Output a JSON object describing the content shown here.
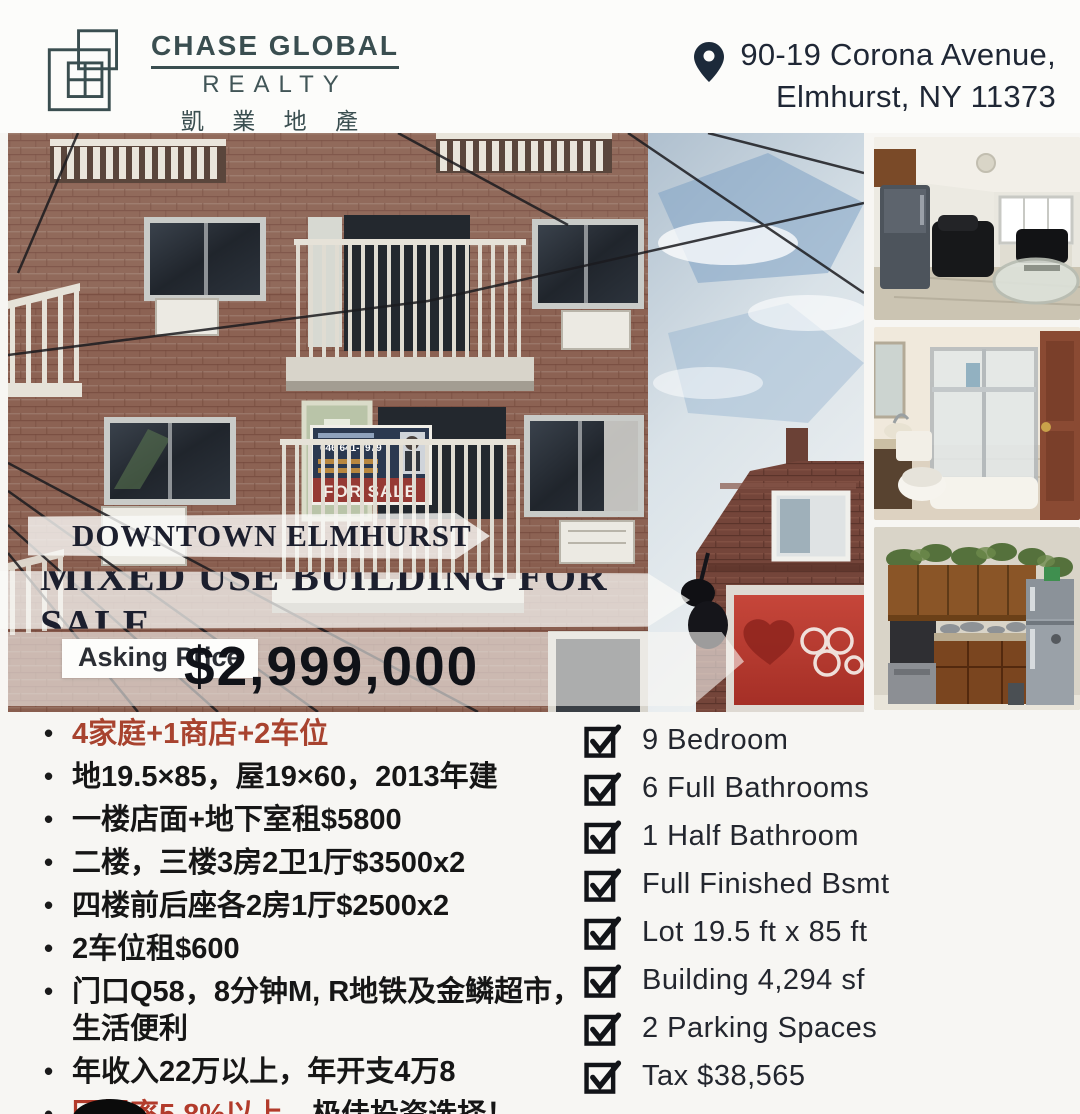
{
  "header": {
    "logo": {
      "name": "CHASE GLOBAL",
      "realty": "REALTY",
      "chinese": "凱 業 地 產"
    },
    "address": {
      "line1": "90-19 Corona Avenue,",
      "line2": "Elmhurst, NY 11373"
    }
  },
  "hero": {
    "location_banner": "DOWNTOWN ELMHURST",
    "title_banner": "MIXED USE BUILDING FOR SALE",
    "price_label": "Asking Price",
    "price_value": "$2,999,000",
    "for_sale_sign": {
      "phone": "646 641-7979",
      "label": "FOR SALE"
    }
  },
  "features_cn": {
    "items": [
      {
        "text": "4家庭+1商店+2车位",
        "highlight": true
      },
      {
        "text": "地19.5×85，屋19×60，2013年建"
      },
      {
        "text": "一楼店面+地下室租$5800"
      },
      {
        "text": "二楼，三楼3房2卫1厅$3500x2"
      },
      {
        "text": "四楼前后座各2房1厅$2500x2"
      },
      {
        "text": "2车位租$600"
      },
      {
        "text": "门口Q58，8分钟M, R地铁及金鳞超市，生活便利"
      },
      {
        "text": "年收入22万以上，年开支4万8"
      },
      {
        "prefix": "回报率5.8%以上",
        "suffix": "，极佳投资选择！"
      }
    ]
  },
  "features_en": {
    "items": [
      "9 Bedroom",
      "6 Full Bathrooms",
      "1 Half Bathroom",
      "Full Finished Bsmt",
      "Lot 19.5 ft x 85 ft",
      "Building 4,294 sf",
      "2 Parking Spaces",
      "Tax $38,565"
    ]
  },
  "colors": {
    "brand": "#3a4e50",
    "accent_red": "#a8432f",
    "banner_ink": "#1c1f2e",
    "price_ink": "#101218",
    "pin": "#1c2a3a"
  }
}
